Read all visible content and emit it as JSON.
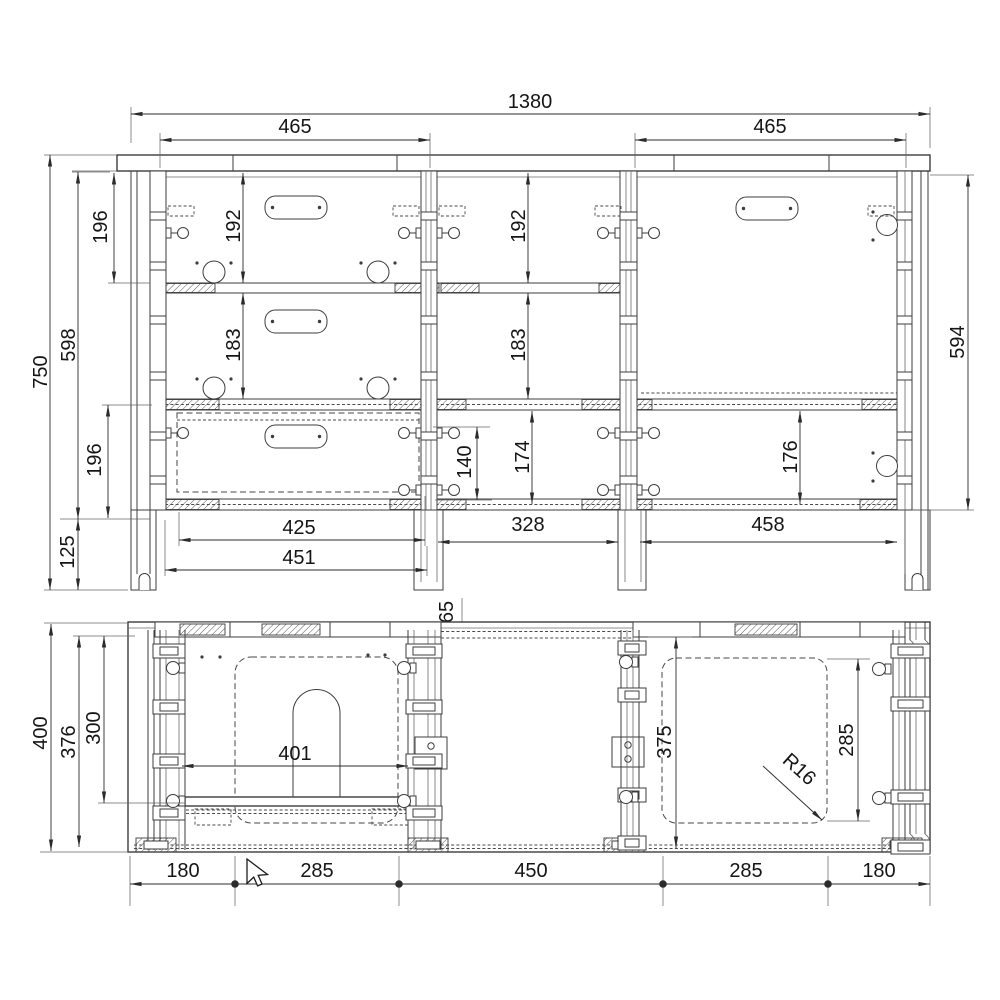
{
  "colors": {
    "line": "#3d3d3d",
    "dim_line": "#2b2b2b",
    "text": "#151515",
    "background": "#ffffff"
  },
  "views": {
    "front": {
      "dims": {
        "overall_width": "1380",
        "left_opening_width": "465",
        "right_opening_width": "465",
        "overall_height": "750",
        "left_side_height": "598",
        "right_side_height": "594",
        "left_upper_offset": "196",
        "left_lower_offset": "196",
        "plinth_height": "125",
        "bay1_upper_height": "192",
        "bay1_middle_height": "183",
        "bay2_upper_height": "192",
        "bay2_middle_height": "183",
        "bay2_lower_height": "174",
        "drawer_box_height": "140",
        "bay3_lower_height": "176",
        "base_inner_width": "425",
        "base_outer_width": "451",
        "base_middle_width": "328",
        "base_right_width": "458",
        "back_rail_offset": "65"
      }
    },
    "plan": {
      "dims": {
        "overall_depth": "400",
        "inner_depth": "376",
        "drawer_depth": "300",
        "cutout_width": "401",
        "door_depth": "375",
        "door_cutout_depth": "285",
        "corner_radius": "R16",
        "width_chain": [
          "180",
          "285",
          "450",
          "285",
          "180"
        ]
      }
    }
  },
  "cursor": {
    "type": "arrow-pointer"
  }
}
